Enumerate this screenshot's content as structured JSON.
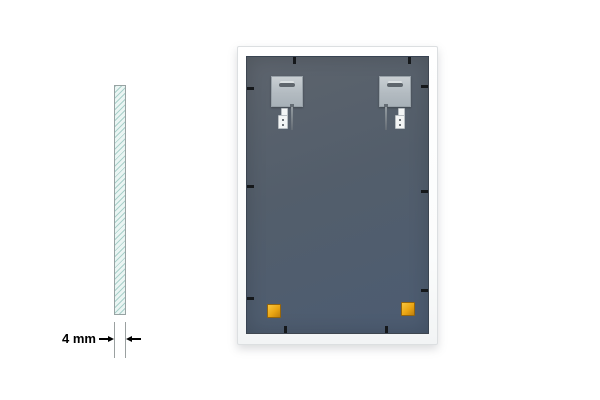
{
  "canvas": {
    "width": 600,
    "height": 400,
    "background": "#ffffff"
  },
  "dimension_annotation": {
    "label": "4 mm"
  },
  "theme": {
    "bg": "#ffffff",
    "text": "#000000",
    "glassFill": "#eaf5f3",
    "glassHatch": "#a9d0ca",
    "glassBorder": "#98a3a3",
    "extLine": "#9aa0a0",
    "frameBorder": "#dcdfe1",
    "panelA": "#5d646d",
    "panelB": "#4c5c72",
    "plateA": "#c9cfd3",
    "plateB": "#a8b1b8",
    "plateBorder": "#98a1a8",
    "slot": "#5f666d",
    "slotHi": "#dce1e3",
    "clip": "#15181b",
    "padA": "#f9c63e",
    "padB": "#eaa512",
    "metal": "#f3f5f5",
    "metalBorder": "#b9bfc3",
    "screwA": "#9aa1a7",
    "screwB": "#646c74"
  },
  "mirror": {
    "hanger_assemblies": [
      {
        "plate_x": 24,
        "anchor_x": 31,
        "screw_x": 44
      },
      {
        "plate_x": 132,
        "anchor_x": 148,
        "screw_x": 138
      }
    ],
    "clips": {
      "top": [
        46,
        161
      ],
      "bottom": [
        37,
        138
      ],
      "left": [
        30,
        128,
        240
      ],
      "right": [
        28,
        133,
        232
      ]
    },
    "pads": [
      {
        "x": 20,
        "y": 247
      },
      {
        "x": 154,
        "y": 245
      }
    ],
    "part_counts": {
      "hanging_plates": 2,
      "wall_plugs": 2,
      "screws": 2,
      "foam_pads": 2,
      "retainer_clips": 10
    }
  }
}
